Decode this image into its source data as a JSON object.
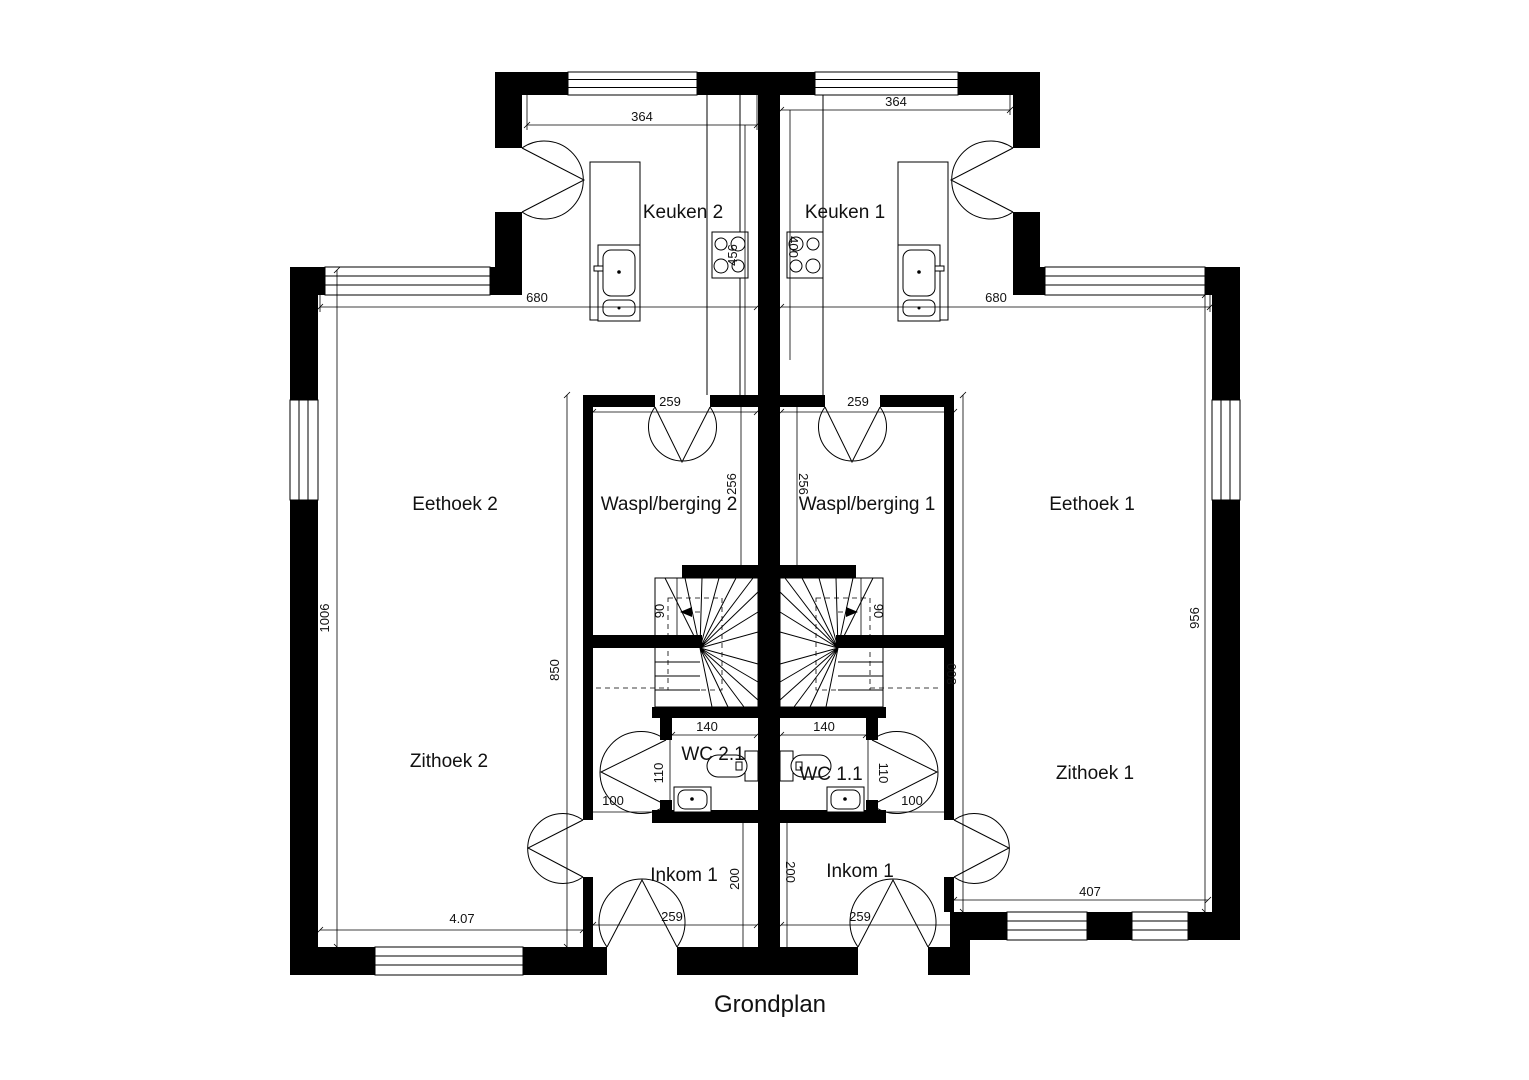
{
  "title": "Grondplan",
  "colors": {
    "wall": "#000000",
    "line": "#000000",
    "background": "#ffffff",
    "text": "#111111"
  },
  "rooms": {
    "keuken_2": "Keuken 2",
    "keuken_1": "Keuken 1",
    "eethoek_2": "Eethoek 2",
    "eethoek_1": "Eethoek 1",
    "waspl_berging_2": "Waspl/berging 2",
    "waspl_berging_1": "Waspl/berging 1",
    "zithoek_2": "Zithoek 2",
    "zithoek_1": "Zithoek 1",
    "wc_2_1": "WC 2.1",
    "wc_1_1": "WC 1.1",
    "inkom_left": "Inkom 1",
    "inkom_right": "Inkom 1"
  },
  "dims": {
    "kitchen_width_left": "364",
    "kitchen_width_right": "364",
    "kitchen_depth_left": "456",
    "kitchen_depth_right": "400",
    "unit_width_left": "680",
    "unit_width_right": "680",
    "waspl_width_left": "259",
    "waspl_width_right": "259",
    "waspl_height_left": "256",
    "waspl_height_right": "256",
    "side_height_left": "1006",
    "side_height_right": "956",
    "core_height_left": "850",
    "core_height_right": "800",
    "stair_walkline_left": "90",
    "stair_walkline_right": "90",
    "wc_width_left": "140",
    "wc_width_right": "140",
    "wc_door_left": "110",
    "wc_door_right": "110",
    "hall_width_left": "100",
    "hall_width_right": "100",
    "inkom_height_left": "200",
    "inkom_height_right": "200",
    "entry_door_left": "259",
    "entry_door_right": "259",
    "zithoek_width_left": "4.07",
    "zithoek_width_right": "407"
  }
}
